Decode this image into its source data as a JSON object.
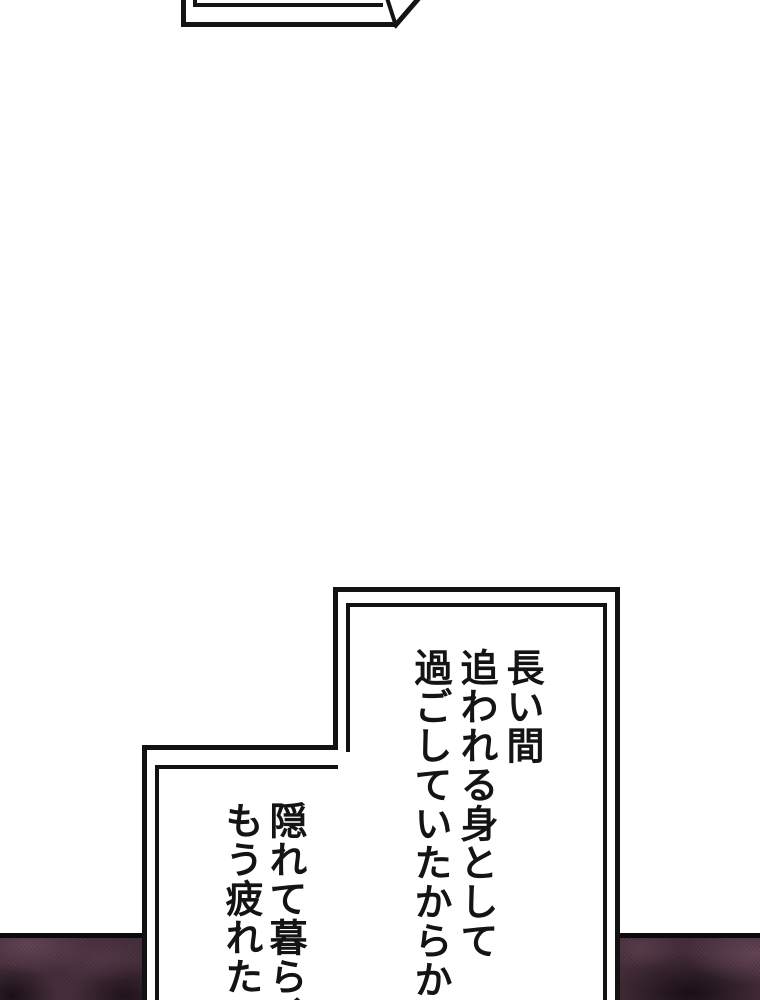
{
  "page": {
    "background_color": "#ffffff",
    "ink_color": "#141414"
  },
  "speech_bubble_top_fragment": {
    "text": ""
  },
  "speech_bubble_main": {
    "lines": [
      "長い間",
      "追われる身として",
      "過ごしていたからか"
    ]
  },
  "speech_bubble_secondary": {
    "lines": [
      "隠れて暮ら、",
      "もう疲れた"
    ]
  },
  "artwork_panel": {
    "base_color": "#412a37",
    "highlight_color": "#5f4050",
    "shadow_color": "#140910",
    "border_color": "#0b0b0b"
  }
}
